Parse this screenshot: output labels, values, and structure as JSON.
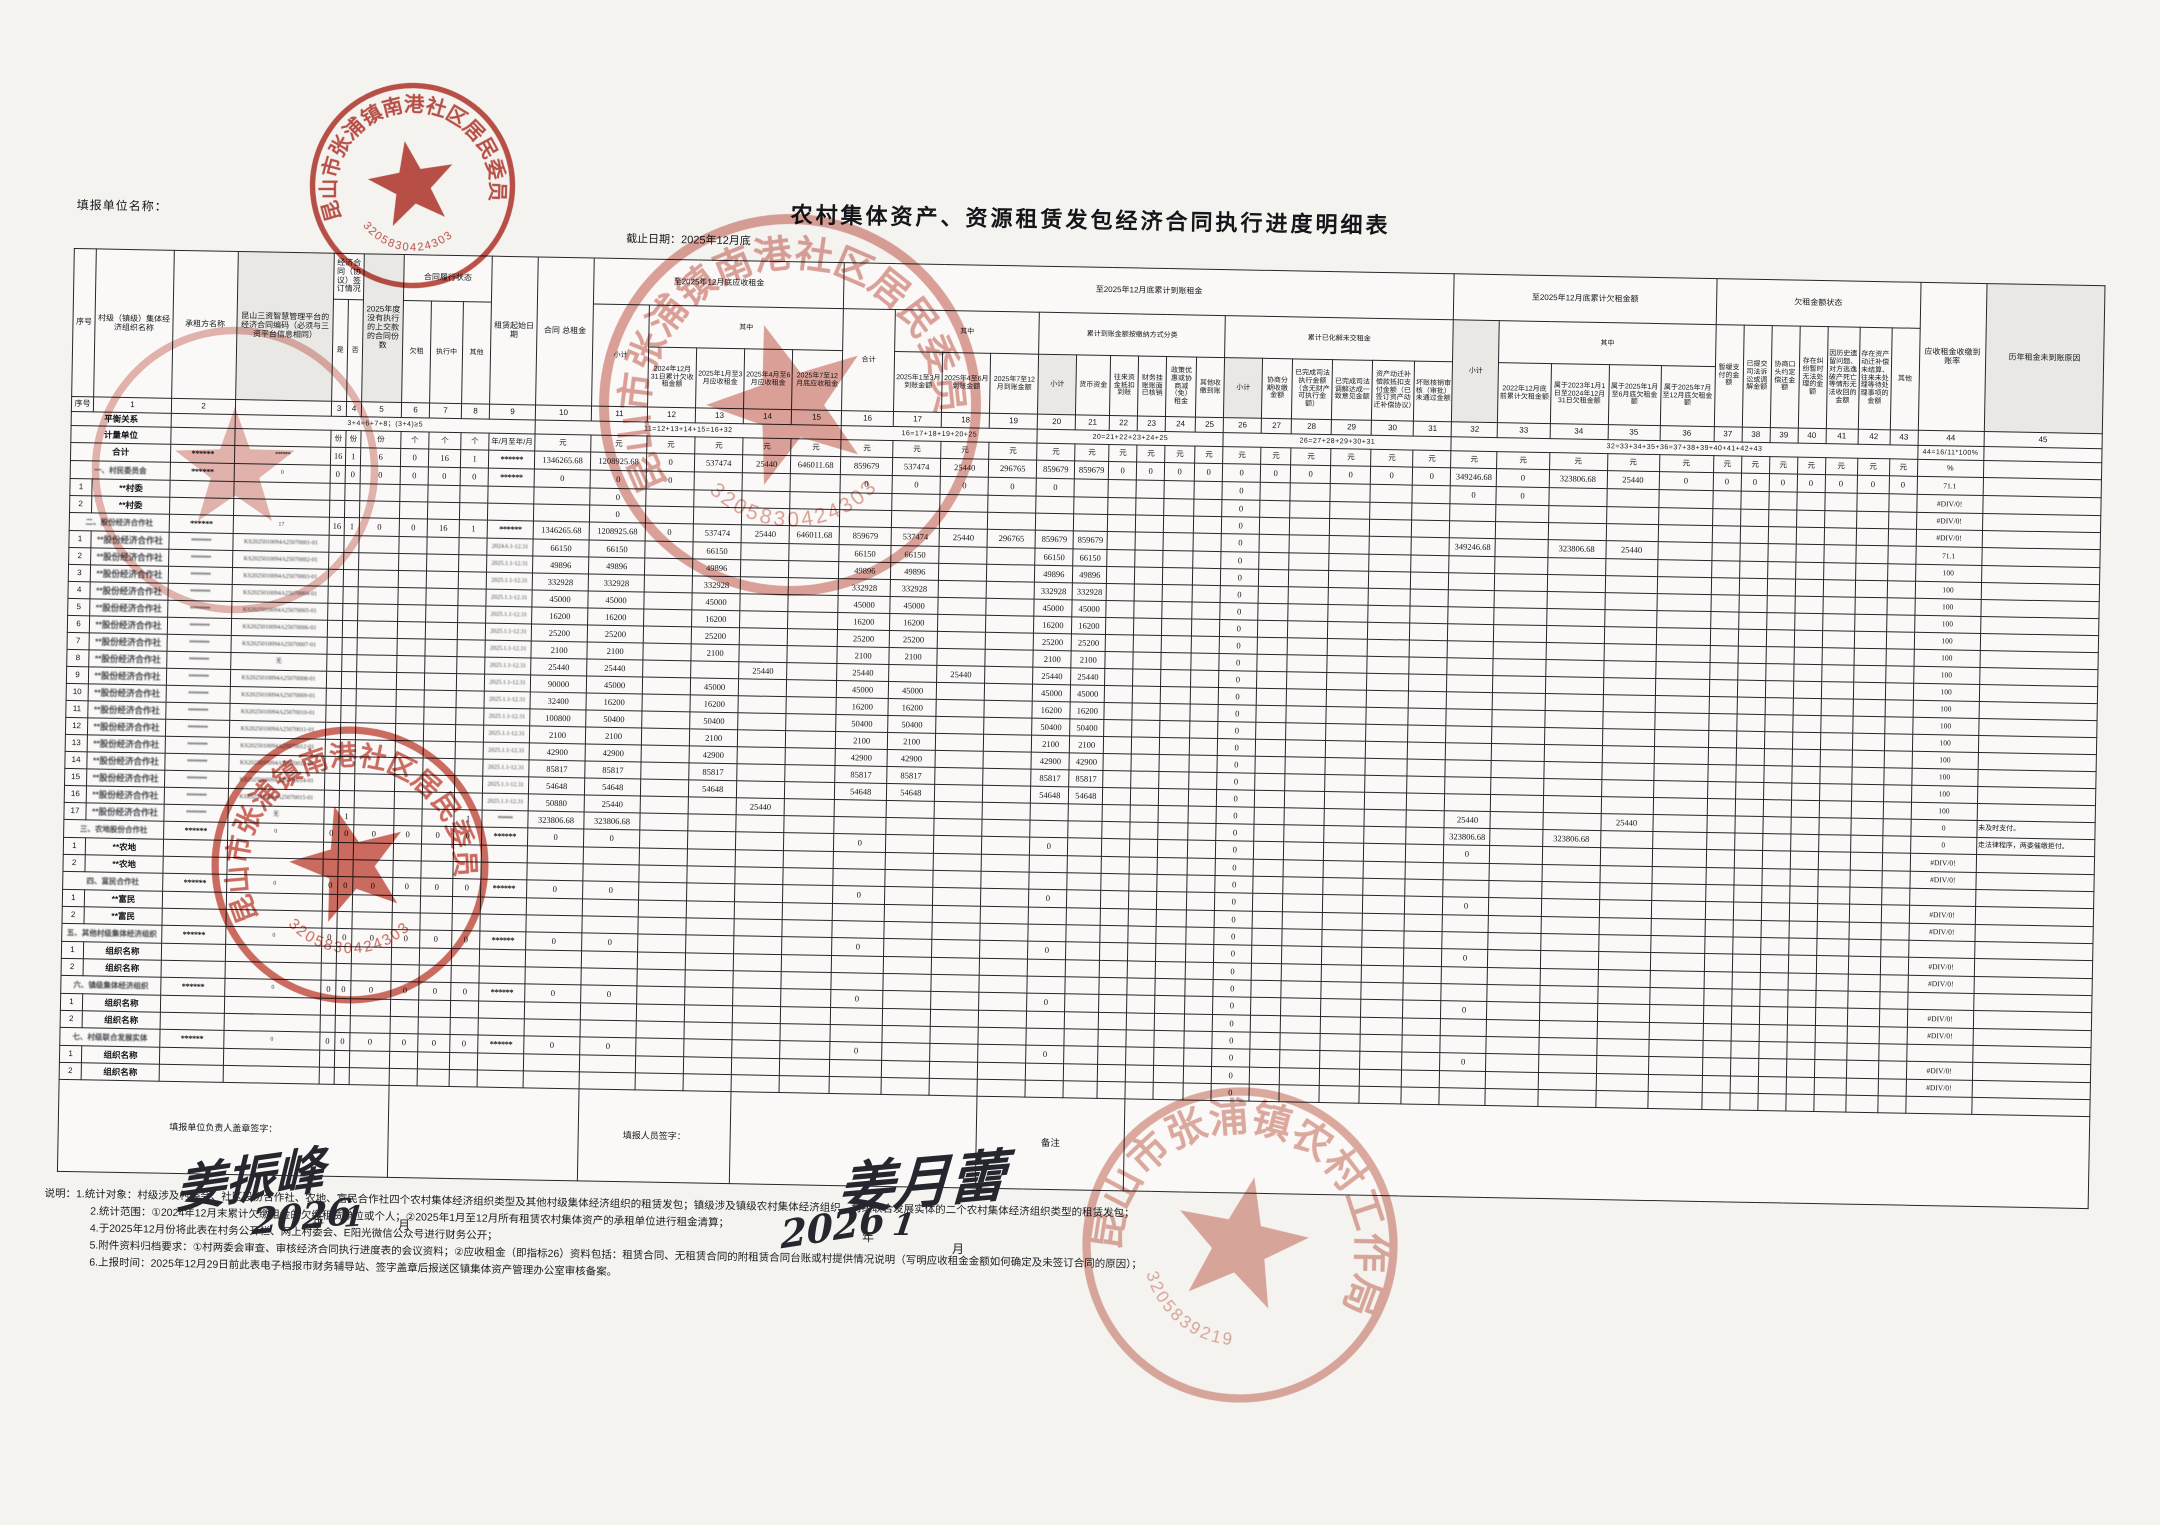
{
  "page": {
    "report_unit_label": "填报单位名称：",
    "title": "农村集体资产、资源租赁发包经济合同执行进度明细表",
    "deadline": "截止日期：2025年12月底"
  },
  "header": {
    "sn": "序号",
    "org": "村级（镇级）集体经济组织名称",
    "tenant": "承租方名称",
    "code": "昆山三资智慧管理平台的经济合同编码（必须与三资平台信息相同）",
    "sign_group": "经济合同（协议）签订情况",
    "yes": "是",
    "no": "否",
    "c5": "2025年度没有执行的上交款的合同份数",
    "perf_group": "合同履行状态",
    "owe": "欠租",
    "exec": "执行中",
    "other": "其他",
    "start_date": "租赁起始日期",
    "contract_total": "合同 总租金",
    "due_group": "至2025年12月底应收租金",
    "due_subtotal": "小计",
    "among": "其中",
    "paid_group": "至2025年12月底累计到账租金",
    "paid_total": "合计",
    "pay_class_group": "累计到账金额按缴纳方式分类",
    "resolved_group": "累计已化解未交租金",
    "owed_group": "至2025年12月底累计欠租金额",
    "owed_subtotal": "小计",
    "status_group": "欠租金额状态",
    "rate": "应收租金收缴到账率",
    "reason": "历年租金未到账原因",
    "cols": {
      "c12": "2024年12月31日累计欠收租金额",
      "c13": "2025年1月至3月应收租金",
      "c14": "2025年4月至6月应收租金",
      "c15": "2025年7至12月底应收租金",
      "c17": "2025年1至3月到账金额",
      "c18": "2025年4至6月到账金额",
      "c19": "2025年7至12月到账金额",
      "c20": "小计",
      "c21": "货币资金",
      "c22": "往来资金抵扣到账",
      "c23": "财务挂账账面已核销",
      "c24": "政策优惠或协商减（免）租金",
      "c25": "其他收缴到账",
      "c26": "小计",
      "c27": "协商分期收缴金额",
      "c28": "已完成司法执行金额（含无财产可执行金额）",
      "c29": "已完成司法调解达成一致意见金额",
      "c30": "资产动迁补偿款抵扣支付金额（已签订资产动迁补偿协议）",
      "c31": "坏账核销审核（审批）未通过金额",
      "c33": "2022年12月底前累计欠租金额",
      "c34": "属于2023年1月1日至2024年12月31日欠租金额",
      "c35": "属于2025年1月至6月底欠租金额",
      "c36": "属于2025年7月至12月底欠租金额",
      "c37": "暂缓支付的金额",
      "c38": "已提交司法诉讼或调解金额",
      "c39": "协商口头约定偿还金额",
      "c40": "存在纠纷暂时无法处理的金额",
      "c41": "因历史遗留问题、对方逃逸破产死亡等情形无法收回的金额",
      "c42": "存在资产动迁补偿未结算、往来未处理等待处理事项的金额",
      "c43": "其他"
    }
  },
  "table": {
    "balance_label": "平衡关系",
    "units_label": "计量单位",
    "col_numbers": {
      "sn": "序号",
      "c1": "1",
      "c2": "2",
      "code": ""
    },
    "balance_formulas": [
      "3+4=6+7+8；(3+4)≥5",
      "11=12+13+14+15=16+32",
      "16=17+18+19+20+25",
      "20=21+22+23+24+25",
      "26=27+28+29+30+31",
      "32=33+34+35+36=37+38+39+40+41+42+43",
      "44=16/11*100%"
    ],
    "units": {
      "c3": "份",
      "c4": "份",
      "c5": "份",
      "c6": "个",
      "c7": "个",
      "c8": "个",
      "c9": "年/月至年/月",
      "c44": "%",
      "c45": "",
      "default": "元"
    }
  },
  "rows": [
    {
      "kind": "total",
      "label": "合计",
      "cells": {
        "c2": "******",
        "code": "******",
        "c3": "16",
        "c4": "1",
        "c5": "6",
        "c6": "0",
        "c7": "16",
        "c8": "1",
        "c9": "******",
        "c10": "1346265.68",
        "c11": "1208925.68",
        "c12": "0",
        "c13": "537474",
        "c14": "25440",
        "c15": "646011.68",
        "c16": "859679",
        "c17": "537474",
        "c18": "25440",
        "c19": "296765",
        "c20": "859679",
        "c21": "859679",
        "c22": "0",
        "c23": "0",
        "c24": "0",
        "c25": "0",
        "c26": "0",
        "c27": "0",
        "c28": "0",
        "c29": "0",
        "c30": "0",
        "c31": "0",
        "c32": "349246.68",
        "c33": "0",
        "c34": "323806.68",
        "c35": "25440",
        "c36": "0",
        "c37": "0",
        "c38": "0",
        "c39": "0",
        "c40": "0",
        "c41": "0",
        "c42": "0",
        "c43": "0",
        "c44": "71.1"
      }
    },
    {
      "kind": "section",
      "label": "一、村民委员会",
      "label_blur": true,
      "cells": {
        "c2": "******",
        "code": "0",
        "c3": "0",
        "c4": "0",
        "c5": "0",
        "c6": "0",
        "c7": "0",
        "c8": "0",
        "c9": "******",
        "c10": "0",
        "c11": "0",
        "c12": "0",
        "c16": "0",
        "c17": "0",
        "c18": "0",
        "c19": "0",
        "c20": "0",
        "c26": "0",
        "c32": "0",
        "c33": "0",
        "c44": "#DIV/0!"
      }
    },
    {
      "kind": "item",
      "num": "1",
      "label": "**村委",
      "cells": {
        "c11": "0",
        "c26": "0",
        "c44": "#DIV/0!"
      }
    },
    {
      "kind": "item",
      "num": "2",
      "label": "**村委",
      "cells": {
        "c11": "0",
        "c26": "0",
        "c44": "#DIV/0!"
      }
    },
    {
      "kind": "section",
      "label": "二、股份经济合作社",
      "label_blur": true,
      "cells": {
        "c2": "******",
        "code": "17",
        "c3": "16",
        "c4": "1",
        "c5": "0",
        "c6": "0",
        "c7": "16",
        "c8": "1",
        "c9": "******",
        "c10": "1346265.68",
        "c11": "1208925.68",
        "c12": "0",
        "c13": "537474",
        "c14": "25440",
        "c15": "646011.68",
        "c16": "859679",
        "c17": "537474",
        "c18": "25440",
        "c19": "296765",
        "c20": "859679",
        "c21": "859679",
        "c26": "0",
        "c32": "349246.68",
        "c34": "323806.68",
        "c35": "25440",
        "c44": "71.1"
      }
    },
    {
      "kind": "item",
      "num": "1",
      "label": "**股份经济合作社",
      "blur": true,
      "cells": {
        "c2": "********",
        "code": "KS2025010094A25070001-01",
        "c9": "2024.6.1-12.31",
        "c10": "66150",
        "c11": "66150",
        "c13": "66150",
        "c16": "66150",
        "c17": "66150",
        "c20": "66150",
        "c21": "66150",
        "c26": "0",
        "c44": "100"
      }
    },
    {
      "kind": "item",
      "num": "2",
      "label": "**股份经济合作社",
      "blur": true,
      "cells": {
        "c2": "********",
        "code": "KS2025010094A25070002-01",
        "c9": "2025.1.1-12.31",
        "c10": "49896",
        "c11": "49896",
        "c13": "49896",
        "c16": "49896",
        "c17": "49896",
        "c20": "49896",
        "c21": "49896",
        "c26": "0",
        "c44": "100"
      }
    },
    {
      "kind": "item",
      "num": "3",
      "label": "**股份经济合作社",
      "blur": true,
      "cells": {
        "c2": "********",
        "code": "KS2025010094A25070003-01",
        "c9": "2025.1.1-12.31",
        "c10": "332928",
        "c11": "332928",
        "c13": "332928",
        "c16": "332928",
        "c17": "332928",
        "c20": "332928",
        "c21": "332928",
        "c26": "0",
        "c44": "100"
      }
    },
    {
      "kind": "item",
      "num": "4",
      "label": "**股份经济合作社",
      "blur": true,
      "cells": {
        "c2": "********",
        "code": "KS2025010094A25070004-01",
        "c9": "2025.1.1-12.31",
        "c10": "45000",
        "c11": "45000",
        "c13": "45000",
        "c16": "45000",
        "c17": "45000",
        "c20": "45000",
        "c21": "45000",
        "c26": "0",
        "c44": "100"
      }
    },
    {
      "kind": "item",
      "num": "5",
      "label": "**股份经济合作社",
      "blur": true,
      "cells": {
        "c2": "********",
        "code": "KS2025010094A25070005-01",
        "c9": "2025.1.1-12.31",
        "c10": "16200",
        "c11": "16200",
        "c13": "16200",
        "c16": "16200",
        "c17": "16200",
        "c20": "16200",
        "c21": "16200",
        "c26": "0",
        "c44": "100"
      }
    },
    {
      "kind": "item",
      "num": "6",
      "label": "**股份经济合作社",
      "blur": true,
      "cells": {
        "c2": "********",
        "code": "KS2025010094A25070006-01",
        "c9": "2025.1.1-12.31",
        "c10": "25200",
        "c11": "25200",
        "c13": "25200",
        "c16": "25200",
        "c17": "25200",
        "c20": "25200",
        "c21": "25200",
        "c26": "0",
        "c44": "100"
      }
    },
    {
      "kind": "item",
      "num": "7",
      "label": "**股份经济合作社",
      "blur": true,
      "cells": {
        "c2": "********",
        "code": "KS2025010094A25070007-01",
        "c9": "2025.1.1-12.31",
        "c10": "2100",
        "c11": "2100",
        "c13": "2100",
        "c16": "2100",
        "c17": "2100",
        "c20": "2100",
        "c21": "2100",
        "c26": "0",
        "c44": "100"
      }
    },
    {
      "kind": "item",
      "num": "8",
      "label": "**股份经济合作社",
      "blur": true,
      "cells": {
        "c2": "********",
        "code": "无",
        "c9": "2025.1.1-12.31",
        "c10": "25440",
        "c11": "25440",
        "c14": "25440",
        "c16": "25440",
        "c18": "25440",
        "c20": "25440",
        "c21": "25440",
        "c26": "0",
        "c44": "100"
      }
    },
    {
      "kind": "item",
      "num": "9",
      "label": "**股份经济合作社",
      "blur": true,
      "cells": {
        "c2": "********",
        "code": "KS2025010094A25070008-01",
        "c9": "2025.1.1-12.31",
        "c10": "90000",
        "c11": "45000",
        "c13": "45000",
        "c16": "45000",
        "c17": "45000",
        "c20": "45000",
        "c21": "45000",
        "c26": "0",
        "c44": "100"
      }
    },
    {
      "kind": "item",
      "num": "10",
      "label": "**股份经济合作社",
      "blur": true,
      "cells": {
        "c2": "********",
        "code": "KS2025010094A25070009-01",
        "c9": "2025.1.1-12.31",
        "c10": "32400",
        "c11": "16200",
        "c13": "16200",
        "c16": "16200",
        "c17": "16200",
        "c20": "16200",
        "c21": "16200",
        "c26": "0",
        "c44": "100"
      }
    },
    {
      "kind": "item",
      "num": "11",
      "label": "**股份经济合作社",
      "blur": true,
      "cells": {
        "c2": "********",
        "code": "KS2025010094A25070010-01",
        "c9": "2025.1.1-12.31",
        "c10": "100800",
        "c11": "50400",
        "c13": "50400",
        "c16": "50400",
        "c17": "50400",
        "c20": "50400",
        "c21": "50400",
        "c26": "0",
        "c44": "100"
      }
    },
    {
      "kind": "item",
      "num": "12",
      "label": "**股份经济合作社",
      "blur": true,
      "cells": {
        "c2": "********",
        "code": "KS2025010094A25070011-01",
        "c9": "2025.1.1-12.31",
        "c10": "2100",
        "c11": "2100",
        "c13": "2100",
        "c16": "2100",
        "c17": "2100",
        "c20": "2100",
        "c21": "2100",
        "c26": "0",
        "c44": "100"
      }
    },
    {
      "kind": "item",
      "num": "13",
      "label": "**股份经济合作社",
      "blur": true,
      "cells": {
        "c2": "********",
        "code": "KS2025010094A25070012-01",
        "c9": "2025.1.1-12.31",
        "c10": "42900",
        "c11": "42900",
        "c13": "42900",
        "c16": "42900",
        "c17": "42900",
        "c20": "42900",
        "c21": "42900",
        "c26": "0",
        "c44": "100"
      }
    },
    {
      "kind": "item",
      "num": "14",
      "label": "**股份经济合作社",
      "blur": true,
      "cells": {
        "c2": "********",
        "code": "KS2025010094A25070013-01",
        "c9": "2025.1.1-12.31",
        "c10": "85817",
        "c11": "85817",
        "c13": "85817",
        "c16": "85817",
        "c17": "85817",
        "c20": "85817",
        "c21": "85817",
        "c26": "0",
        "c44": "100"
      }
    },
    {
      "kind": "item",
      "num": "15",
      "label": "**股份经济合作社",
      "blur": true,
      "cells": {
        "c2": "********",
        "code": "KS2025010094A25070014-01",
        "c9": "2025.1.1-12.31",
        "c10": "54648",
        "c11": "54648",
        "c13": "54648",
        "c16": "54648",
        "c17": "54648",
        "c20": "54648",
        "c21": "54648",
        "c26": "0",
        "c44": "100"
      }
    },
    {
      "kind": "item",
      "num": "16",
      "label": "**股份经济合作社",
      "blur": true,
      "cells": {
        "c2": "********",
        "code": "KS2025010094A25070015-01",
        "c9": "2025.1.1-12.31",
        "c10": "50880",
        "c11": "25440",
        "c14": "25440",
        "c26": "0",
        "c32": "25440",
        "c35": "25440",
        "c44": "0",
        "c45": "未及时支付。"
      }
    },
    {
      "kind": "item",
      "num": "17",
      "label": "**股份经济合作社",
      "blur": true,
      "cells": {
        "c2": "********",
        "code": "无",
        "c4": "1",
        "c8": "1",
        "c9": "******",
        "c10": "323806.68",
        "c11": "323806.68",
        "c26": "0",
        "c32": "323806.68",
        "c34": "323806.68",
        "c44": "0",
        "c45": "走法律程序，两委催缴拒付。"
      }
    },
    {
      "kind": "section",
      "label": "三、农地股份合作社",
      "label_blur": true,
      "cells": {
        "c2": "******",
        "code": "0",
        "c3": "0",
        "c4": "0",
        "c5": "0",
        "c6": "0",
        "c7": "0",
        "c8": "0",
        "c9": "******",
        "c10": "0",
        "c11": "0",
        "c16": "0",
        "c20": "0",
        "c26": "0",
        "c32": "0",
        "c44": "#DIV/0!"
      }
    },
    {
      "kind": "item",
      "num": "1",
      "label": "**农地",
      "cells": {
        "c26": "0",
        "c44": "#DIV/0!"
      }
    },
    {
      "kind": "item",
      "num": "2",
      "label": "**农地",
      "cells": {
        "c26": "0"
      }
    },
    {
      "kind": "section",
      "label": "四、富民合作社",
      "label_blur": true,
      "cells": {
        "c2": "******",
        "code": "0",
        "c3": "0",
        "c4": "0",
        "c5": "0",
        "c6": "0",
        "c7": "0",
        "c8": "0",
        "c9": "******",
        "c10": "0",
        "c11": "0",
        "c16": "0",
        "c20": "0",
        "c26": "0",
        "c32": "0",
        "c44": "#DIV/0!"
      }
    },
    {
      "kind": "item",
      "num": "1",
      "label": "**富民",
      "cells": {
        "c26": "0",
        "c44": "#DIV/0!"
      }
    },
    {
      "kind": "item",
      "num": "2",
      "label": "**富民",
      "cells": {
        "c26": "0"
      }
    },
    {
      "kind": "section",
      "label": "五、其他村级集体经济组织",
      "label_blur": true,
      "cells": {
        "c2": "******",
        "code": "0",
        "c3": "0",
        "c4": "0",
        "c5": "0",
        "c6": "0",
        "c7": "0",
        "c8": "0",
        "c9": "******",
        "c10": "0",
        "c11": "0",
        "c16": "0",
        "c20": "0",
        "c26": "0",
        "c32": "0",
        "c44": "#DIV/0!"
      }
    },
    {
      "kind": "item",
      "num": "1",
      "label": "组织名称",
      "cells": {
        "c26": "0",
        "c44": "#DIV/0!"
      }
    },
    {
      "kind": "item",
      "num": "2",
      "label": "组织名称",
      "cells": {
        "c26": "0"
      }
    },
    {
      "kind": "section",
      "label": "六、镇级集体经济组织",
      "label_blur": true,
      "cells": {
        "c2": "******",
        "code": "0",
        "c3": "0",
        "c4": "0",
        "c5": "0",
        "c6": "0",
        "c7": "0",
        "c8": "0",
        "c9": "******",
        "c10": "0",
        "c11": "0",
        "c16": "0",
        "c20": "0",
        "c26": "0",
        "c32": "0",
        "c44": "#DIV/0!"
      }
    },
    {
      "kind": "item",
      "num": "1",
      "label": "组织名称",
      "cells": {
        "c26": "0",
        "c44": "#DIV/0!"
      }
    },
    {
      "kind": "item",
      "num": "2",
      "label": "组织名称",
      "cells": {
        "c26": "0"
      }
    },
    {
      "kind": "section",
      "label": "七、村级联合发展实体",
      "label_blur": true,
      "cells": {
        "c2": "******",
        "code": "0",
        "c3": "0",
        "c4": "0",
        "c5": "0",
        "c6": "0",
        "c7": "0",
        "c8": "0",
        "c9": "******",
        "c10": "0",
        "c11": "0",
        "c16": "0",
        "c20": "0",
        "c26": "0",
        "c32": "0",
        "c44": "#DIV/0!"
      }
    },
    {
      "kind": "item",
      "num": "1",
      "label": "组织名称",
      "cells": {
        "c26": "0",
        "c44": "#DIV/0!"
      }
    },
    {
      "kind": "item",
      "num": "2",
      "label": "组织名称",
      "cells": {
        "c26": "0"
      }
    }
  ],
  "signatures": {
    "leader_label": "填报单位负责人盖章签字：",
    "staff_label": "填报人员签字：",
    "remark_label": "备注",
    "year_label": "年",
    "month_label": "月"
  },
  "handwriting": [
    {
      "text": "姜振峰",
      "x": 175,
      "y": 1140,
      "size": 50,
      "rotate": -8
    },
    {
      "text": "2026",
      "x": 252,
      "y": 1196,
      "size": 36,
      "rotate": -6
    },
    {
      "text": "1",
      "x": 344,
      "y": 1200,
      "size": 28,
      "rotate": -4
    },
    {
      "text": "姜月蕾",
      "x": 838,
      "y": 1138,
      "size": 56,
      "rotate": -5
    },
    {
      "text": "2026",
      "x": 780,
      "y": 1204,
      "size": 38,
      "rotate": -9
    },
    {
      "text": "1",
      "x": 893,
      "y": 1208,
      "size": 30,
      "rotate": 0
    }
  ],
  "printed_marks": [
    {
      "text": "年",
      "x": 312,
      "y": 1212
    },
    {
      "text": "月",
      "x": 398,
      "y": 1216
    },
    {
      "text": "年",
      "x": 862,
      "y": 1228
    },
    {
      "text": "月",
      "x": 952,
      "y": 1240
    }
  ],
  "stamps": [
    {
      "org": "昆山市张浦镇南港社区居民委员会",
      "number": "3205830424303",
      "color": "#b5342a",
      "opacity": 0.85,
      "x": 305,
      "y": 78,
      "size": 215,
      "rotate": -10
    },
    {
      "org": "昆山市张浦镇南港社区居民委员会",
      "number": "3205830424303",
      "color": "#c04a3c",
      "opacity": 0.5,
      "x": 590,
      "y": 205,
      "size": 400,
      "rotate": -18
    },
    {
      "org": "",
      "number": "",
      "color": "#c04a3c",
      "opacity": 0.4,
      "x": 85,
      "y": 320,
      "size": 300,
      "rotate": 0
    },
    {
      "org": "昆山市张浦镇南港社区居民委员会",
      "number": "3205830424303",
      "color": "#bf3a2b",
      "opacity": 0.75,
      "x": 205,
      "y": 720,
      "size": 290,
      "rotate": -15
    },
    {
      "org": "昆山市张浦镇农村工作局",
      "number": "3205839219",
      "color": "#d07f72",
      "opacity": 0.65,
      "x": 1075,
      "y": 1080,
      "size": 330,
      "rotate": 12
    }
  ],
  "notes": {
    "intro": "说明：",
    "lines": [
      "1.统计对象：村级涉及村委会、社区股份合作社、农地、富民合作社四个农村集体经济组织类型及其他村级集体经济组织的租赁发包；镇级涉及镇级农村集体经济组织、村级联合发展实体的二个农村集体经济组织类型的租赁发包；",
      "2.统计范围：①2024年12月末累计欠缴租金的欠缴租赁单位或个人；②2025年1月至12月所有租赁农村集体资产的承租单位进行租金清算；",
      "4.于2025年12月份将此表在村务公开栏、网上村委会、E阳光微信公众号进行财务公开；",
      "5.附件资料归档要求：①村两委会审查、审核经济合同执行进度表的会议资料；②应收租金（即指标26）资料包括：租赁合同、无租赁合同的附租赁合同台账或村提供情况说明（写明应收租金金额如何确定及未签订合同的原因）；",
      "6.上报时间：2025年12月29日前此表电子档报市财务辅导站、签字盖章后报送区镇集体资产管理办公室审核备案。"
    ]
  }
}
